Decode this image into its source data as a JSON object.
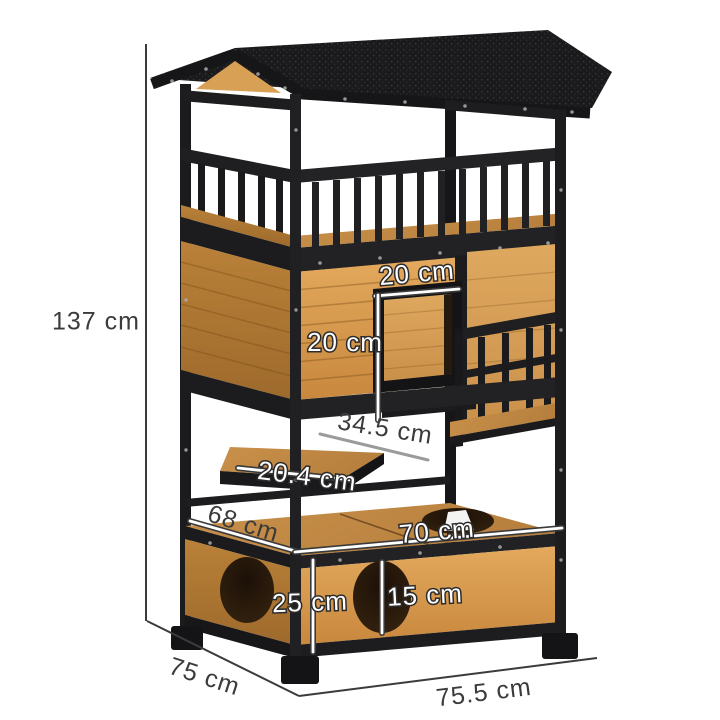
{
  "image": {
    "description": "Wooden outdoor cat house tower with black frame, gabled asphalt roof, railed balcony, enclosed house level with square entrance, step platform and litter-box base with round openings, annotated with product dimensions",
    "colors": {
      "wood_front": "#d9a050",
      "wood_side": "#b27c3a",
      "wood_top": "#c38c44",
      "frame_black": "#1d1d1f",
      "roof_black": "#1a1a1c",
      "annotation_dark": "#3b3b3b",
      "annotation_white": "#ffffff"
    }
  },
  "dimensions": {
    "overall_height": "137 cm",
    "entrance_width": "20 cm",
    "entrance_height": "20 cm",
    "step_length": "34.5 cm",
    "step_depth": "20.4 cm",
    "base_top_depth": "68 cm",
    "base_top_width": "70 cm",
    "base_height": "25 cm",
    "side_hole_diameter": "15 cm",
    "overall_depth": "75 cm",
    "overall_width": "75.5 cm"
  }
}
